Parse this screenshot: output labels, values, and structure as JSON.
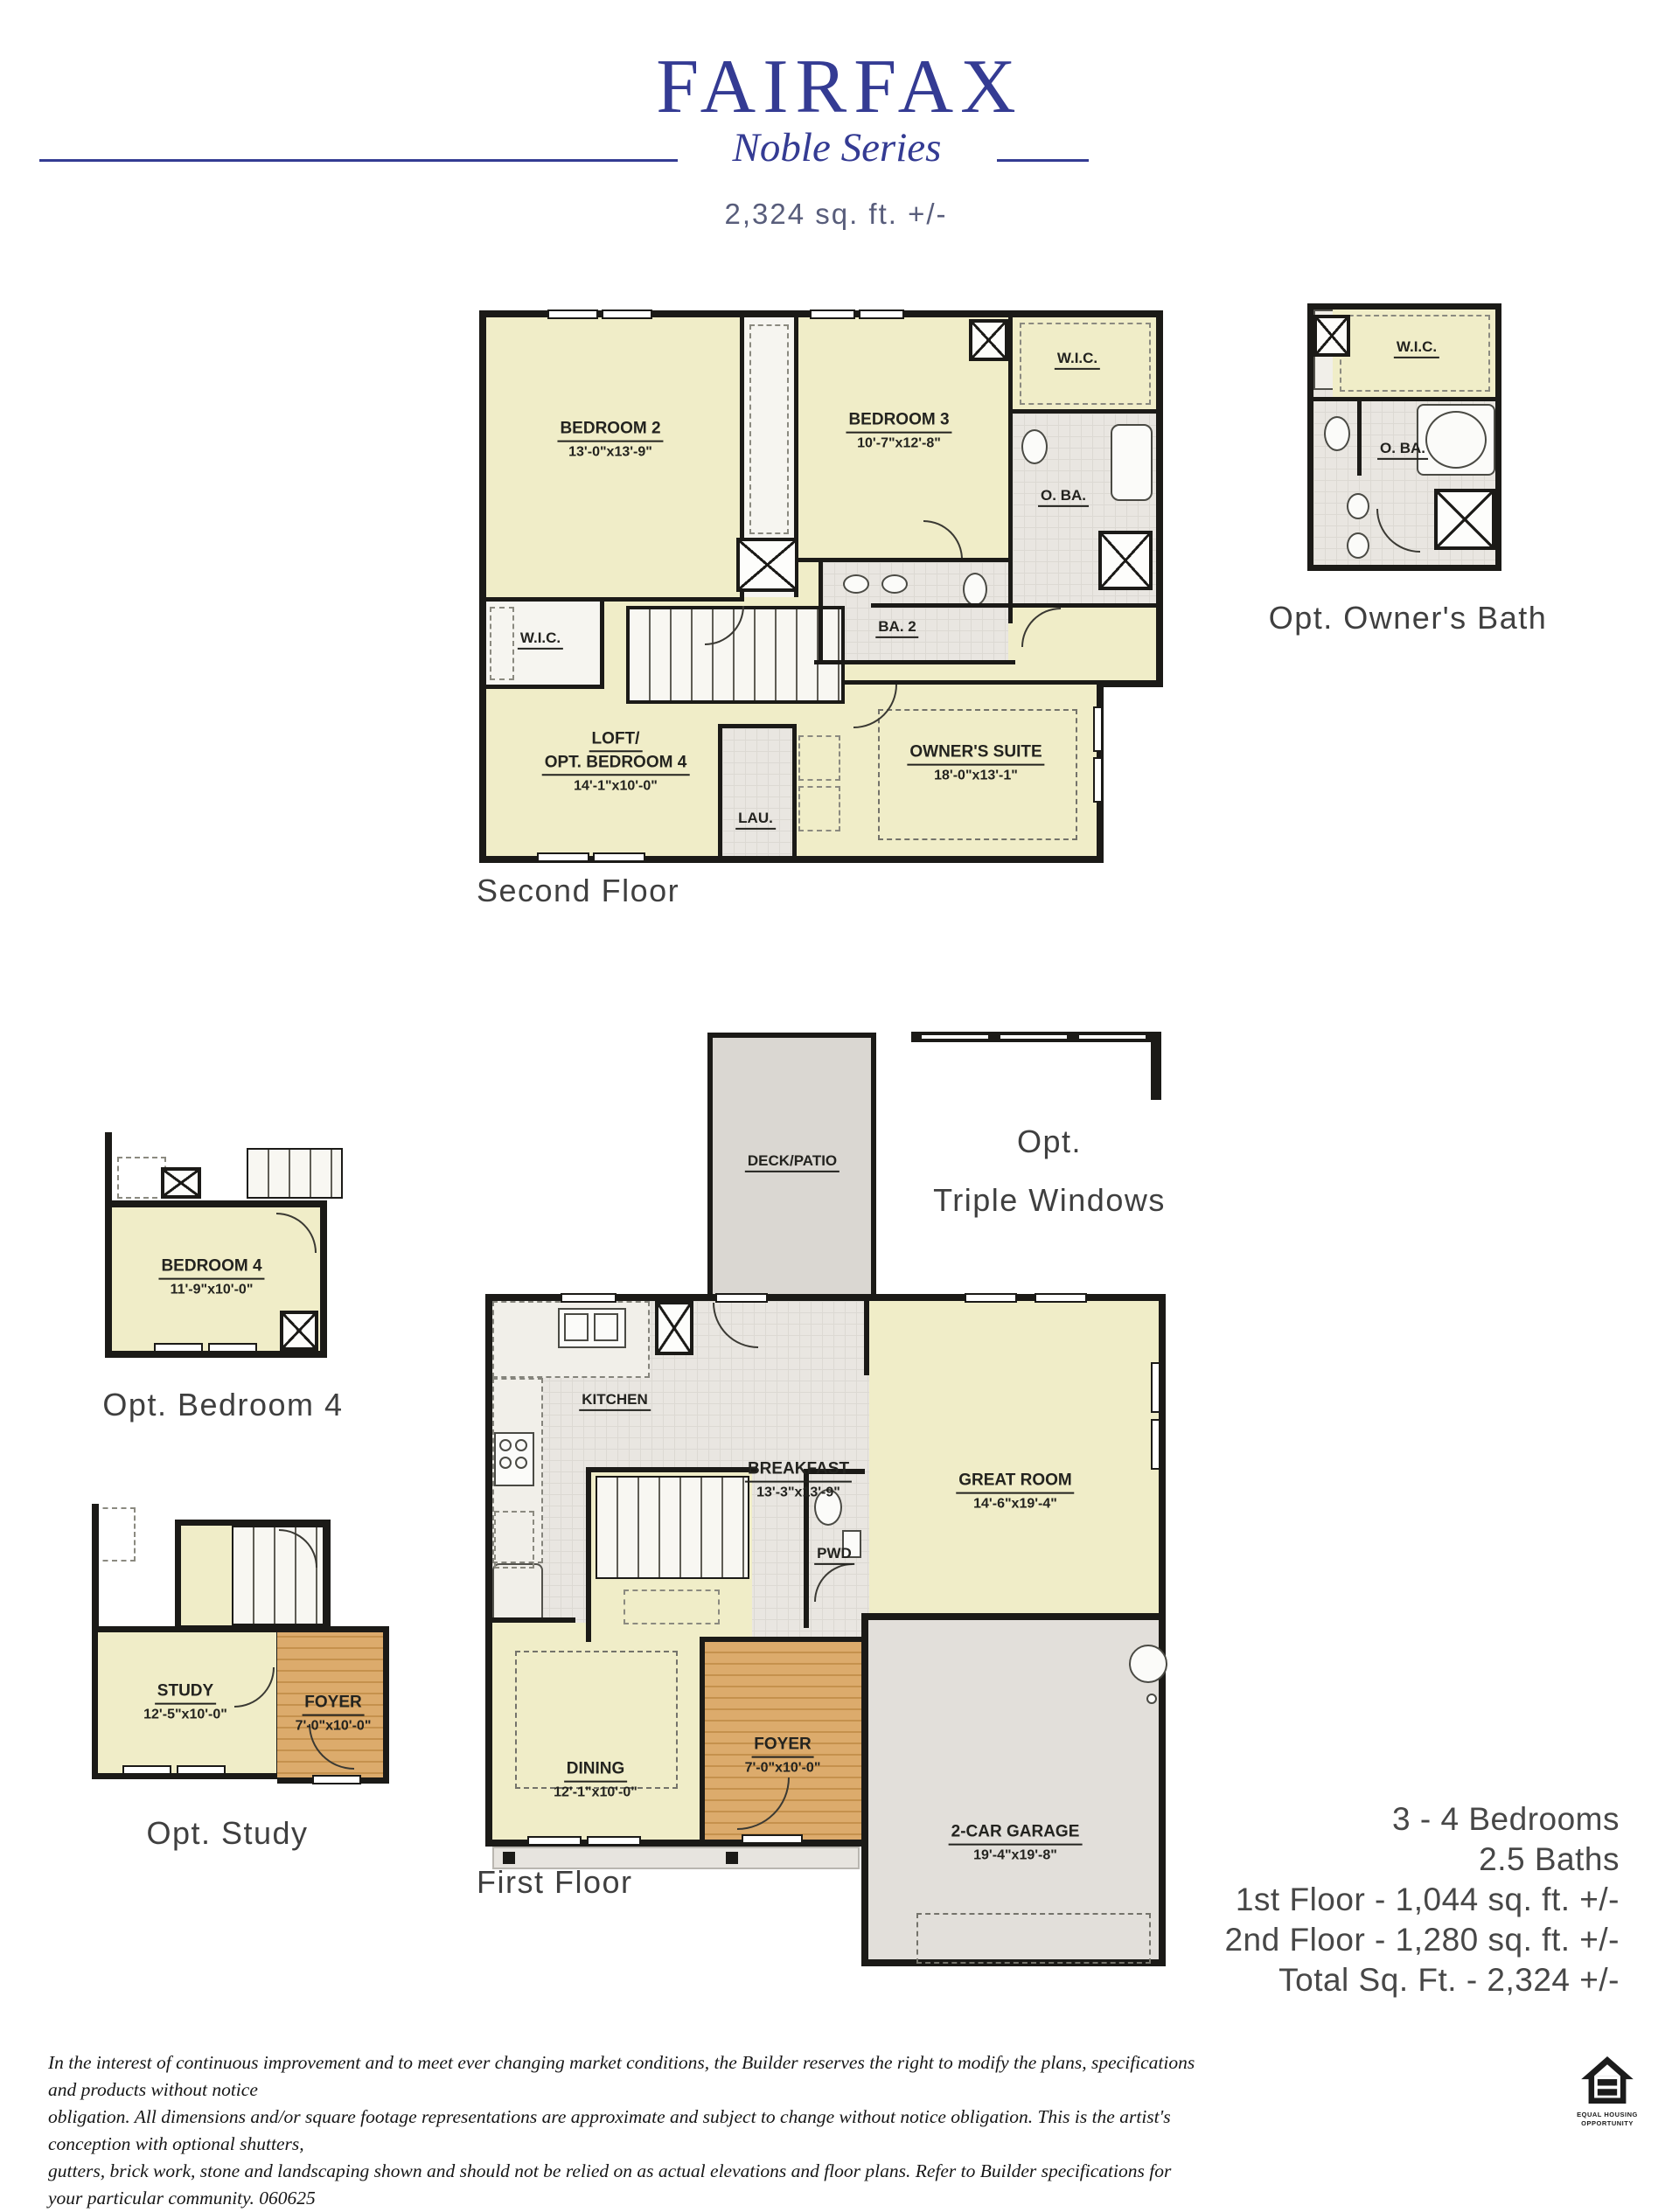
{
  "header": {
    "title": "FAIRFAX",
    "series": "Noble Series",
    "sqft": "2,324 sq. ft. +/-"
  },
  "second_floor": {
    "caption": "Second Floor",
    "rooms": {
      "bedroom2": {
        "name": "BEDROOM 2",
        "dims": "13'-0\"x13'-9\""
      },
      "bedroom3": {
        "name": "BEDROOM 3",
        "dims": "10'-7\"x12'-8\""
      },
      "wic_top_right": {
        "name": "W.I.C."
      },
      "oba": {
        "name": "O. BA."
      },
      "ba2": {
        "name": "BA. 2"
      },
      "wic_left": {
        "name": "W.I.C."
      },
      "loft": {
        "name1": "LOFT/",
        "name2": "OPT. BEDROOM 4",
        "dims": "14'-1\"x10'-0\""
      },
      "lau": {
        "name": "LAU."
      },
      "owners_suite": {
        "name": "OWNER'S SUITE",
        "dims": "18'-0\"x13'-1\""
      }
    }
  },
  "opt_owners_bath": {
    "caption": "Opt. Owner's Bath",
    "rooms": {
      "wic": {
        "name": "W.I.C."
      },
      "oba": {
        "name": "O. BA."
      }
    }
  },
  "first_floor": {
    "caption": "First Floor",
    "deck": {
      "name": "DECK/PATIO"
    },
    "opt_windows": {
      "line1": "Opt.",
      "line2": "Triple Windows"
    },
    "rooms": {
      "kitchen": {
        "name": "KITCHEN"
      },
      "breakfast": {
        "name": "BREAKFAST",
        "dims": "13'-3\"x13'-9\""
      },
      "great_room": {
        "name": "GREAT ROOM",
        "dims": "14'-6\"x19'-4\""
      },
      "pwd": {
        "name": "PWD"
      },
      "dining": {
        "name": "DINING",
        "dims": "12'-1\"x10'-0\""
      },
      "foyer": {
        "name": "FOYER",
        "dims": "7'-0\"x10'-0\""
      },
      "garage": {
        "name": "2-CAR GARAGE",
        "dims": "19'-4\"x19'-8\""
      }
    }
  },
  "opt_bedroom4": {
    "caption": "Opt. Bedroom 4",
    "room": {
      "name": "BEDROOM 4",
      "dims": "11'-9\"x10'-0\""
    }
  },
  "opt_study": {
    "caption": "Opt. Study",
    "study": {
      "name": "STUDY",
      "dims": "12'-5\"x10'-0\""
    },
    "foyer": {
      "name": "FOYER",
      "dims": "7'-0\"x10'-0\""
    }
  },
  "stats": {
    "lines": [
      "3 - 4 Bedrooms",
      "2.5 Baths",
      "1st Floor - 1,044 sq. ft. +/-",
      "2nd Floor - 1,280 sq. ft. +/-",
      "Total Sq. Ft. - 2,324 +/-"
    ]
  },
  "disclaimer": {
    "lines": [
      "In the interest of continuous improvement and to meet ever changing market conditions, the Builder reserves the right to modify the plans,  specifications and products without notice",
      "obligation. All dimensions and/or square footage representations are approximate and subject to change without notice obligation. This is the artist's conception with optional shutters,",
      "gutters, brick work, stone and landscaping shown and should not be relied on as actual elevations and floor plans. Refer to Builder specifications for your particular community. 060625"
    ]
  },
  "equal_housing": {
    "line1": "EQUAL HOUSING",
    "line2": "OPPORTUNITY"
  }
}
